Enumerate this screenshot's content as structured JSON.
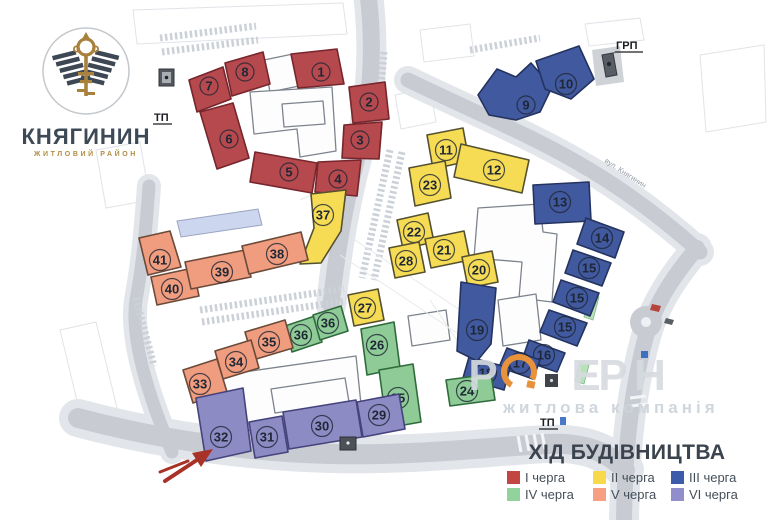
{
  "logo": {
    "title": "КНЯГИНИН",
    "subtitle": "ЖИТЛОВИЙ РАЙОН"
  },
  "legend": {
    "title": "ХІД БУДІВНИЦТВА",
    "items": [
      {
        "id": "I",
        "label": "І черга",
        "color": "#c24642"
      },
      {
        "id": "II",
        "label": "ІІ черга",
        "color": "#f8d94c"
      },
      {
        "id": "III",
        "label": "ІІІ черга",
        "color": "#3c5cab"
      },
      {
        "id": "IV",
        "label": "IV черга",
        "color": "#92d29c"
      },
      {
        "id": "V",
        "label": "V черга",
        "color": "#f79e83"
      },
      {
        "id": "VI",
        "label": "VI черга",
        "color": "#908ecb"
      }
    ]
  },
  "map": {
    "labels": {
      "grp": "ГРП",
      "tp_left": "ТП",
      "tp_bottom": "ТП",
      "street_ne": "вул. Княгинин"
    },
    "watermark": {
      "line1_letters": [
        {
          "ch": "Р",
          "x": 483
        },
        {
          "ch": "Е",
          "x": 586
        },
        {
          "ch": "Р",
          "x": 613
        },
        {
          "ch": "Н",
          "x": 650
        }
      ],
      "line2": "житлова компанія"
    },
    "phase_styles": {
      "I": {
        "fill": "#b5494d",
        "stroke": "#76262c"
      },
      "II": {
        "fill": "#f6dc55",
        "stroke": "#55512f"
      },
      "III": {
        "fill": "#41599f",
        "stroke": "#24335f"
      },
      "IV": {
        "fill": "#8ecb96",
        "stroke": "#2f6b3c"
      },
      "V": {
        "fill": "#f09c7e",
        "stroke": "#6b4a39"
      },
      "VI": {
        "fill": "#8d8bc4",
        "stroke": "#45437c"
      }
    },
    "buildings": [
      {
        "num": "7",
        "phase": "I",
        "pts": [
          [
            189,
            80
          ],
          [
            223,
            67
          ],
          [
            231,
            99
          ],
          [
            197,
            112
          ]
        ],
        "lx": 209,
        "ly": 86
      },
      {
        "num": "8",
        "phase": "I",
        "pts": [
          [
            225,
            63
          ],
          [
            263,
            52
          ],
          [
            270,
            84
          ],
          [
            232,
            96
          ]
        ],
        "lx": 245,
        "ly": 72
      },
      {
        "num": "1",
        "phase": "I",
        "pts": [
          [
            291,
            54
          ],
          [
            337,
            49
          ],
          [
            344,
            84
          ],
          [
            298,
            88
          ]
        ],
        "lx": 321,
        "ly": 72
      },
      {
        "num": "2",
        "phase": "I",
        "pts": [
          [
            349,
            87
          ],
          [
            385,
            82
          ],
          [
            389,
            119
          ],
          [
            353,
            123
          ]
        ],
        "lx": 369,
        "ly": 102
      },
      {
        "num": "3",
        "phase": "I",
        "pts": [
          [
            344,
            125
          ],
          [
            382,
            122
          ],
          [
            379,
            159
          ],
          [
            342,
            158
          ]
        ],
        "lx": 360,
        "ly": 140
      },
      {
        "num": "4",
        "phase": "I",
        "pts": [
          [
            318,
            162
          ],
          [
            361,
            160
          ],
          [
            357,
            196
          ],
          [
            315,
            192
          ]
        ],
        "lx": 338,
        "ly": 179
      },
      {
        "num": "5",
        "phase": "I",
        "pts": [
          [
            255,
            152
          ],
          [
            317,
            163
          ],
          [
            312,
            193
          ],
          [
            250,
            182
          ]
        ],
        "lx": 289,
        "ly": 172
      },
      {
        "num": "6",
        "phase": "I",
        "pts": [
          [
            200,
            112
          ],
          [
            233,
            103
          ],
          [
            249,
            158
          ],
          [
            217,
            169
          ]
        ],
        "lx": 229,
        "ly": 139
      },
      {
        "num": "37",
        "phase": "II",
        "pts": [
          [
            311,
            194
          ],
          [
            346,
            190
          ],
          [
            341,
            231
          ],
          [
            321,
            263
          ],
          [
            300,
            264
          ],
          [
            314,
            228
          ]
        ],
        "lx": 323,
        "ly": 215
      },
      {
        "num": "11",
        "phase": "II",
        "pts": [
          [
            427,
            135
          ],
          [
            463,
            128
          ],
          [
            469,
            161
          ],
          [
            433,
            169
          ]
        ],
        "lx": 446,
        "ly": 150
      },
      {
        "num": "12",
        "phase": "II",
        "pts": [
          [
            461,
            144
          ],
          [
            529,
            160
          ],
          [
            522,
            193
          ],
          [
            454,
            177
          ]
        ],
        "lx": 494,
        "ly": 170
      },
      {
        "num": "23",
        "phase": "II",
        "pts": [
          [
            409,
            168
          ],
          [
            445,
            161
          ],
          [
            451,
            198
          ],
          [
            415,
            206
          ]
        ],
        "lx": 430,
        "ly": 185
      },
      {
        "num": "22",
        "phase": "II",
        "pts": [
          [
            397,
            220
          ],
          [
            428,
            213
          ],
          [
            434,
            242
          ],
          [
            403,
            249
          ]
        ],
        "lx": 414,
        "ly": 232
      },
      {
        "num": "21",
        "phase": "II",
        "pts": [
          [
            425,
            239
          ],
          [
            464,
            231
          ],
          [
            470,
            260
          ],
          [
            431,
            268
          ]
        ],
        "lx": 444,
        "ly": 250
      },
      {
        "num": "20",
        "phase": "II",
        "pts": [
          [
            462,
            257
          ],
          [
            492,
            251
          ],
          [
            498,
            282
          ],
          [
            468,
            288
          ]
        ],
        "lx": 479,
        "ly": 270
      },
      {
        "num": "28",
        "phase": "II",
        "pts": [
          [
            389,
            248
          ],
          [
            419,
            242
          ],
          [
            425,
            272
          ],
          [
            395,
            278
          ]
        ],
        "lx": 406,
        "ly": 261
      },
      {
        "num": "27",
        "phase": "II",
        "pts": [
          [
            348,
            295
          ],
          [
            378,
            289
          ],
          [
            384,
            320
          ],
          [
            354,
            326
          ]
        ],
        "lx": 365,
        "ly": 308
      },
      {
        "num": "9",
        "phase": "III",
        "pts": [
          [
            478,
            95
          ],
          [
            497,
            69
          ],
          [
            516,
            77
          ],
          [
            531,
            63
          ],
          [
            552,
            87
          ],
          [
            540,
            112
          ],
          [
            516,
            120
          ],
          [
            489,
            115
          ]
        ],
        "lx": 526,
        "ly": 105
      },
      {
        "num": "10",
        "phase": "III",
        "pts": [
          [
            536,
            61
          ],
          [
            579,
            46
          ],
          [
            594,
            79
          ],
          [
            571,
            99
          ],
          [
            545,
            89
          ]
        ],
        "lx": 566,
        "ly": 84
      },
      {
        "num": "13",
        "phase": "III",
        "pts": [
          [
            533,
            185
          ],
          [
            589,
            182
          ],
          [
            591,
            221
          ],
          [
            535,
            224
          ]
        ],
        "lx": 560,
        "ly": 202
      },
      {
        "num": "14",
        "phase": "III",
        "pts": [
          [
            586,
            218
          ],
          [
            624,
            232
          ],
          [
            615,
            258
          ],
          [
            577,
            244
          ]
        ],
        "lx": 602,
        "ly": 238
      },
      {
        "num": "15",
        "phase": "III",
        "pts": [
          [
            573,
            250
          ],
          [
            611,
            263
          ],
          [
            602,
            286
          ],
          [
            565,
            273
          ]
        ],
        "lx": 589,
        "ly": 268
      },
      {
        "num": "15",
        "phase": "III",
        "pts": [
          [
            561,
            280
          ],
          [
            599,
            293
          ],
          [
            590,
            316
          ],
          [
            553,
            302
          ]
        ],
        "lx": 577,
        "ly": 298
      },
      {
        "num": "15",
        "phase": "III",
        "pts": [
          [
            549,
            310
          ],
          [
            587,
            323
          ],
          [
            577,
            346
          ],
          [
            540,
            332
          ]
        ],
        "lx": 565,
        "ly": 327
      },
      {
        "num": "16",
        "phase": "III",
        "pts": [
          [
            529,
            340
          ],
          [
            565,
            353
          ],
          [
            557,
            372
          ],
          [
            522,
            360
          ]
        ],
        "lx": 544,
        "ly": 355
      },
      {
        "num": "17",
        "phase": "III",
        "pts": [
          [
            507,
            348
          ],
          [
            540,
            360
          ],
          [
            533,
            379
          ],
          [
            499,
            367
          ]
        ],
        "lx": 520,
        "ly": 363
      },
      {
        "num": "18",
        "phase": "III",
        "pts": [
          [
            469,
            357
          ],
          [
            510,
            368
          ],
          [
            504,
            390
          ],
          [
            463,
            378
          ]
        ],
        "lx": 486,
        "ly": 373
      },
      {
        "num": "19",
        "phase": "III",
        "pts": [
          [
            461,
            282
          ],
          [
            496,
            288
          ],
          [
            491,
            344
          ],
          [
            477,
            361
          ],
          [
            457,
            351
          ]
        ],
        "lx": 477,
        "ly": 330
      },
      {
        "num": "36",
        "phase": "IV",
        "pts": [
          [
            285,
            326
          ],
          [
            315,
            316
          ],
          [
            322,
            342
          ],
          [
            292,
            352
          ]
        ],
        "lx": 301,
        "ly": 335
      },
      {
        "num": "36",
        "phase": "IV",
        "pts": [
          [
            313,
            315
          ],
          [
            341,
            306
          ],
          [
            348,
            331
          ],
          [
            320,
            340
          ]
        ],
        "lx": 328,
        "ly": 323
      },
      {
        "num": "26",
        "phase": "IV",
        "pts": [
          [
            361,
            329
          ],
          [
            394,
            322
          ],
          [
            400,
            368
          ],
          [
            367,
            375
          ]
        ],
        "lx": 377,
        "ly": 345
      },
      {
        "num": "25",
        "phase": "IV",
        "pts": [
          [
            379,
            370
          ],
          [
            413,
            364
          ],
          [
            421,
            422
          ],
          [
            387,
            428
          ]
        ],
        "lx": 398,
        "ly": 398
      },
      {
        "num": "24",
        "phase": "IV",
        "pts": [
          [
            446,
            380
          ],
          [
            491,
            374
          ],
          [
            495,
            400
          ],
          [
            450,
            406
          ]
        ],
        "lx": 467,
        "ly": 391
      },
      {
        "num": "41",
        "phase": "V",
        "pts": [
          [
            139,
            238
          ],
          [
            170,
            231
          ],
          [
            181,
            267
          ],
          [
            148,
            275
          ]
        ],
        "lx": 160,
        "ly": 260
      },
      {
        "num": "40",
        "phase": "V",
        "pts": [
          [
            151,
            277
          ],
          [
            193,
            268
          ],
          [
            199,
            296
          ],
          [
            157,
            305
          ]
        ],
        "lx": 172,
        "ly": 289
      },
      {
        "num": "39",
        "phase": "V",
        "pts": [
          [
            185,
            262
          ],
          [
            245,
            250
          ],
          [
            251,
            277
          ],
          [
            191,
            289
          ]
        ],
        "lx": 222,
        "ly": 272
      },
      {
        "num": "38",
        "phase": "V",
        "pts": [
          [
            242,
            246
          ],
          [
            301,
            232
          ],
          [
            308,
            260
          ],
          [
            249,
            274
          ]
        ],
        "lx": 277,
        "ly": 254
      },
      {
        "num": "35",
        "phase": "V",
        "pts": [
          [
            245,
            332
          ],
          [
            285,
            320
          ],
          [
            293,
            348
          ],
          [
            253,
            360
          ]
        ],
        "lx": 269,
        "ly": 342
      },
      {
        "num": "34",
        "phase": "V",
        "pts": [
          [
            215,
            351
          ],
          [
            251,
            340
          ],
          [
            259,
            368
          ],
          [
            223,
            379
          ]
        ],
        "lx": 236,
        "ly": 362
      },
      {
        "num": "33",
        "phase": "V",
        "pts": [
          [
            183,
            370
          ],
          [
            217,
            359
          ],
          [
            227,
            392
          ],
          [
            193,
            403
          ]
        ],
        "lx": 200,
        "ly": 384
      },
      {
        "num": "32",
        "phase": "VI",
        "pts": [
          [
            196,
            398
          ],
          [
            243,
            388
          ],
          [
            251,
            451
          ],
          [
            206,
            461
          ]
        ],
        "lx": 221,
        "ly": 437
      },
      {
        "num": "31",
        "phase": "VI",
        "pts": [
          [
            249,
            422
          ],
          [
            282,
            416
          ],
          [
            288,
            452
          ],
          [
            255,
            458
          ]
        ],
        "lx": 267,
        "ly": 437
      },
      {
        "num": "30",
        "phase": "VI",
        "pts": [
          [
            283,
            412
          ],
          [
            356,
            400
          ],
          [
            362,
            437
          ],
          [
            289,
            449
          ]
        ],
        "lx": 322,
        "ly": 426
      },
      {
        "num": "29",
        "phase": "VI",
        "pts": [
          [
            357,
            402
          ],
          [
            399,
            394
          ],
          [
            405,
            429
          ],
          [
            363,
            437
          ]
        ],
        "lx": 379,
        "ly": 415
      }
    ]
  }
}
